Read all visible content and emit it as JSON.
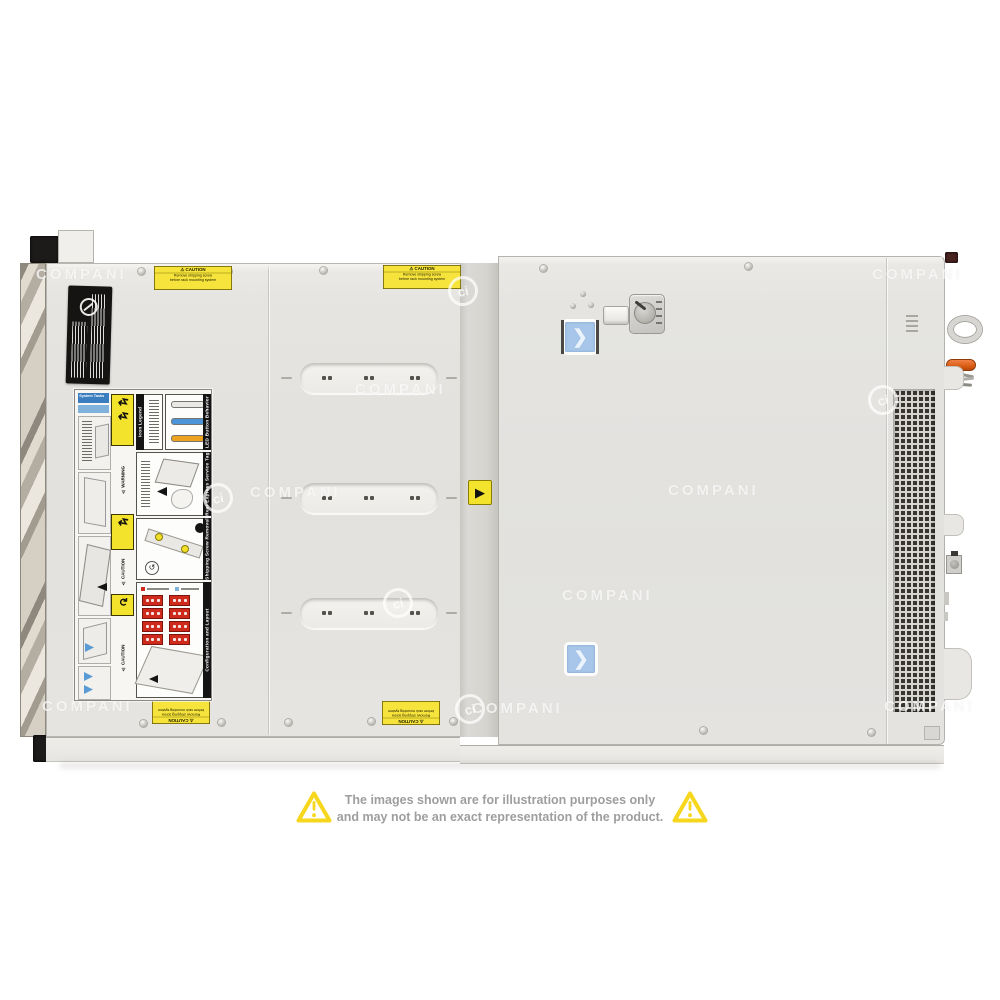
{
  "disclaimer": {
    "line1": "The images shown are for illustration purposes only",
    "line2": "and may not be an exact representation of the product.",
    "text_color": "#9e9ea0",
    "triangle_color": "#f6d71d"
  },
  "watermark": {
    "text": "COMPANI",
    "logo": "ci",
    "text_items": [
      [
        36,
        266
      ],
      [
        872,
        266
      ],
      [
        355,
        381
      ],
      [
        250,
        484
      ],
      [
        668,
        482
      ],
      [
        562,
        587
      ],
      [
        42,
        698
      ],
      [
        472,
        700
      ],
      [
        884,
        698
      ]
    ],
    "logo_items": [
      [
        448,
        276
      ],
      [
        868,
        385
      ],
      [
        203,
        483
      ],
      [
        383,
        588
      ],
      [
        455,
        694
      ]
    ]
  },
  "chassis": {
    "caution_label": {
      "title": "⚠ CAUTION",
      "line1": "Remove shipping screw",
      "line2": "before rack mounting system"
    },
    "divider_label_glyph": "▶",
    "latch_chevron": "❯",
    "service_label": {
      "chip1": "System Tasks",
      "headers": {
        "icon_legend": "Icon Legend",
        "led": "LED Button Behavior",
        "service_tag": "Rear Express Service Tag",
        "shipping": "Shipping Screw Removal",
        "config": "Configuration and Layout",
        "warning": "⚠ WARNING",
        "caution": "⚠ CAUTION"
      },
      "arrow_glyph": "↯",
      "cycle_glyph": "↻",
      "led_colors": [
        "#e9e8e4",
        "#4b94d8",
        "#eda21f"
      ],
      "drive_grid": {
        "stacks": 2,
        "rows": 4,
        "dots": 3,
        "color": "#cf2b1d"
      }
    },
    "colors": {
      "label_yellow": "#f6e33b",
      "button_blue": "#a7c6e9",
      "handle_orange": "#d4570f",
      "drive_red": "#cf2b1d",
      "led_blue": "#4b94d8",
      "led_orange": "#eda21f"
    },
    "screws": [
      [
        138,
        268
      ],
      [
        225,
        268
      ],
      [
        320,
        267
      ],
      [
        420,
        267
      ],
      [
        540,
        265
      ],
      [
        745,
        263
      ],
      [
        140,
        720
      ],
      [
        218,
        719
      ],
      [
        285,
        719
      ],
      [
        368,
        718
      ],
      [
        450,
        718
      ],
      [
        700,
        727
      ],
      [
        868,
        729
      ]
    ],
    "slots": [
      [
        300,
        363
      ],
      [
        300,
        483
      ],
      [
        300,
        598
      ]
    ],
    "slot_dot_offsets": [
      22,
      28,
      64,
      70,
      110,
      116
    ]
  }
}
